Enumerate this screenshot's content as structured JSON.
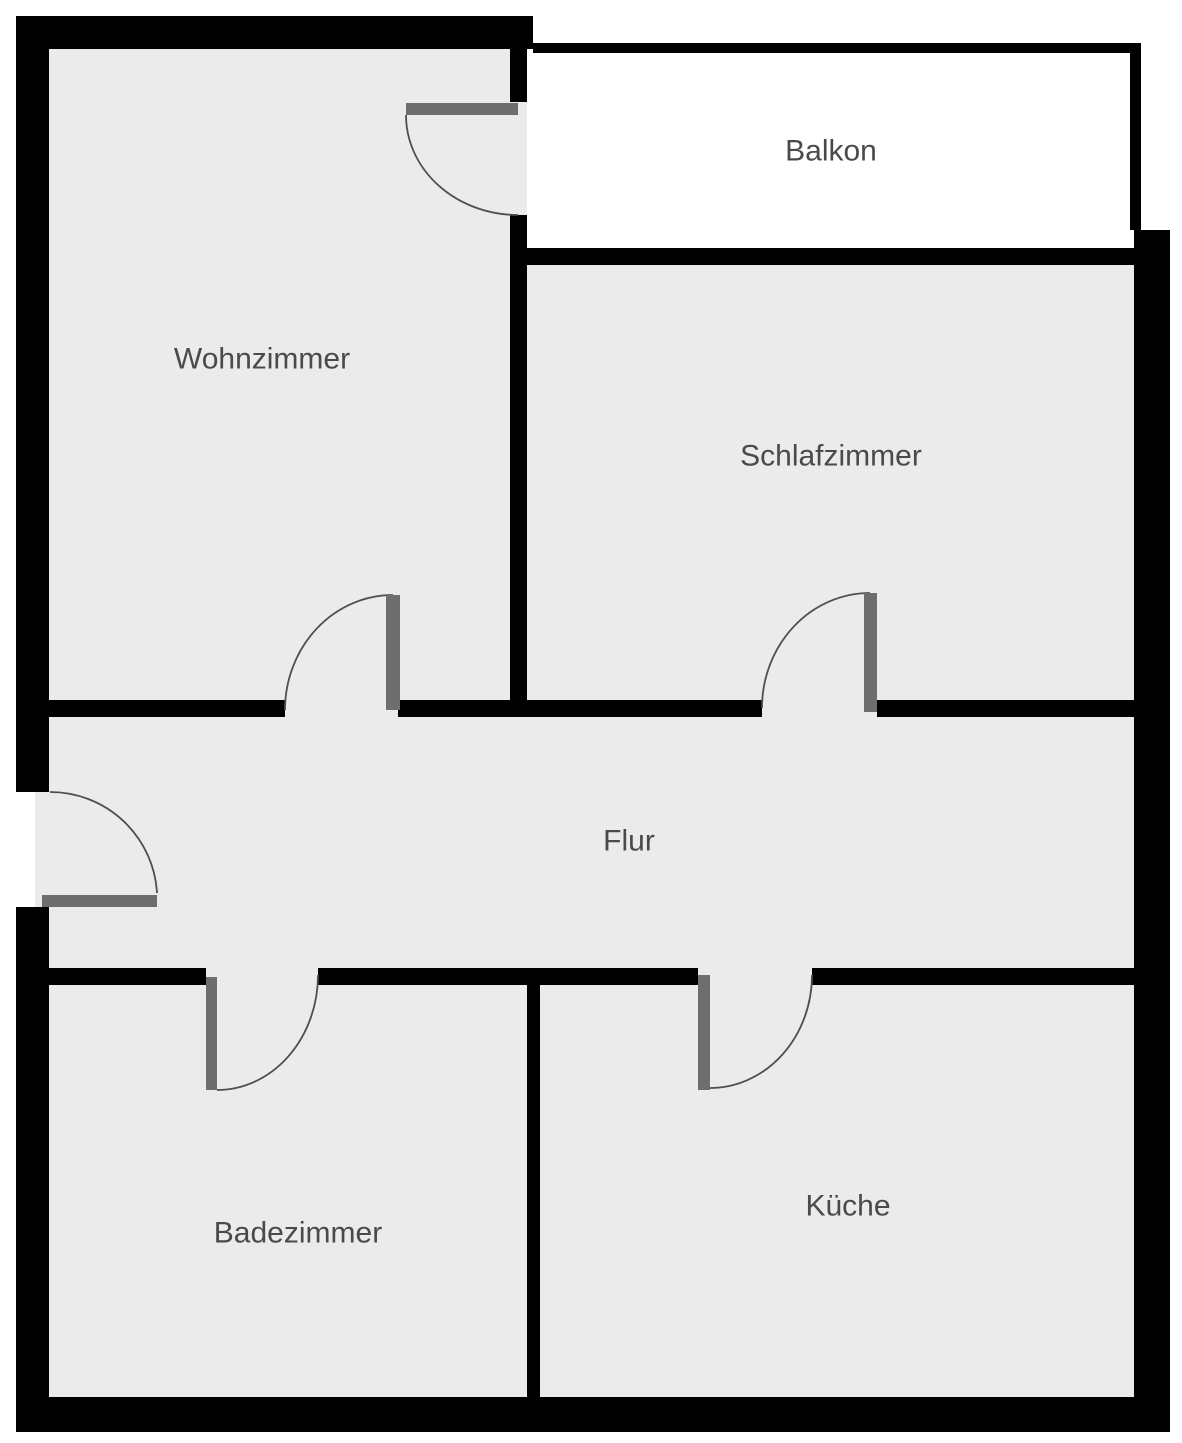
{
  "diagram_type": "apartment-floor-plan",
  "canvas": {
    "width": 1182,
    "height": 1443
  },
  "colors": {
    "background": "#ffffff",
    "wall": "#000000",
    "floor": "#ebebeb",
    "balcony_floor": "#ffffff",
    "door_leaf": "#6e6e6e",
    "door_arc": "#4f4f4f",
    "label_text": "#4a4a4a"
  },
  "label_font_size": 30,
  "rooms": [
    {
      "name": "wohnzimmer",
      "label": "Wohnzimmer",
      "x": 49,
      "y": 49,
      "w": 461,
      "h": 651,
      "fill": "floor",
      "label_x": 262,
      "label_y": 359
    },
    {
      "name": "balkon",
      "label": "Balkon",
      "x": 527,
      "y": 53,
      "w": 603,
      "h": 195,
      "fill": "balcony_floor",
      "label_x": 831,
      "label_y": 151
    },
    {
      "name": "schlafzimmer",
      "label": "Schlafzimmer",
      "x": 527,
      "y": 265,
      "w": 607,
      "h": 435,
      "fill": "floor",
      "label_x": 831,
      "label_y": 456
    },
    {
      "name": "flur",
      "label": "Flur",
      "x": 49,
      "y": 717,
      "w": 1085,
      "h": 251,
      "fill": "floor",
      "label_x": 629,
      "label_y": 841
    },
    {
      "name": "badezimmer",
      "label": "Badezimmer",
      "x": 49,
      "y": 985,
      "w": 478,
      "h": 412,
      "fill": "floor",
      "label_x": 298,
      "label_y": 1233
    },
    {
      "name": "kueche",
      "label": "Küche",
      "x": 540,
      "y": 985,
      "w": 594,
      "h": 412,
      "fill": "floor",
      "label_x": 848,
      "label_y": 1206
    }
  ],
  "door_openings": [
    {
      "name": "opening-balkon-tuer",
      "x": 510,
      "y": 102,
      "w": 17,
      "h": 113,
      "fill": "floor"
    },
    {
      "name": "opening-wohnzimmer-tuer",
      "x": 285,
      "y": 700,
      "w": 113,
      "h": 17,
      "fill": "floor"
    },
    {
      "name": "opening-schlafzimmer-tuer",
      "x": 762,
      "y": 700,
      "w": 115,
      "h": 17,
      "fill": "floor"
    },
    {
      "name": "opening-badezimmer-tuer",
      "x": 206,
      "y": 968,
      "w": 112,
      "h": 17,
      "fill": "floor"
    },
    {
      "name": "opening-kueche-tuer",
      "x": 698,
      "y": 968,
      "w": 114,
      "h": 17,
      "fill": "floor"
    },
    {
      "name": "opening-eingang-schwelle",
      "x": 35,
      "y": 792,
      "w": 14,
      "h": 115,
      "fill": "floor"
    }
  ],
  "walls": [
    {
      "name": "wall-outer-top",
      "x": 16,
      "y": 16,
      "w": 517,
      "h": 33
    },
    {
      "name": "wall-outer-left-upper",
      "x": 16,
      "y": 16,
      "w": 33,
      "h": 776
    },
    {
      "name": "wall-outer-left-lower",
      "x": 16,
      "y": 907,
      "w": 33,
      "h": 525
    },
    {
      "name": "wall-outer-bottom",
      "x": 16,
      "y": 1397,
      "w": 1154,
      "h": 35
    },
    {
      "name": "wall-outer-right",
      "x": 1134,
      "y": 230,
      "w": 36,
      "h": 1202
    },
    {
      "name": "wall-balkon-rail-top",
      "x": 533,
      "y": 43,
      "w": 608,
      "h": 10
    },
    {
      "name": "wall-balkon-rail-right",
      "x": 1130,
      "y": 43,
      "w": 11,
      "h": 187
    },
    {
      "name": "wall-balkon-bottom",
      "x": 510,
      "y": 248,
      "w": 624,
      "h": 17
    },
    {
      "name": "wall-wohnzimmer-ost-oben",
      "x": 510,
      "y": 43,
      "w": 17,
      "h": 59
    },
    {
      "name": "wall-wohnzimmer-ost-unten",
      "x": 510,
      "y": 215,
      "w": 17,
      "h": 502
    },
    {
      "name": "wall-flur-nord-west",
      "x": 49,
      "y": 700,
      "w": 236,
      "h": 17
    },
    {
      "name": "wall-flur-nord-mitte",
      "x": 398,
      "y": 700,
      "w": 364,
      "h": 17
    },
    {
      "name": "wall-flur-nord-ost",
      "x": 877,
      "y": 700,
      "w": 257,
      "h": 17
    },
    {
      "name": "wall-flur-sued-west",
      "x": 49,
      "y": 968,
      "w": 157,
      "h": 17
    },
    {
      "name": "wall-flur-sued-mitte",
      "x": 318,
      "y": 968,
      "w": 380,
      "h": 17
    },
    {
      "name": "wall-flur-sued-ost",
      "x": 812,
      "y": 968,
      "w": 322,
      "h": 17
    },
    {
      "name": "wall-bad-kueche-trenner",
      "x": 527,
      "y": 985,
      "w": 13,
      "h": 412
    }
  ],
  "doors": [
    {
      "name": "balkon-tuer",
      "leaf": {
        "x": 406,
        "y": 103,
        "w": 112,
        "h": 12
      },
      "arc": "M 406 115 A 112 100 0 0 0 518 215"
    },
    {
      "name": "wohnzimmer-tuer",
      "leaf": {
        "x": 386,
        "y": 595,
        "w": 14,
        "h": 115
      },
      "arc": "M 393 595 A 108 115 0 0 0 285 710"
    },
    {
      "name": "schlafzimmer-tuer",
      "leaf": {
        "x": 864,
        "y": 593,
        "w": 13,
        "h": 119
      },
      "arc": "M 870 593 A 108 115 0 0 0 762 708"
    },
    {
      "name": "eingangs-tuer",
      "leaf": {
        "x": 42,
        "y": 895,
        "w": 115,
        "h": 12
      },
      "arc": "M 50 792 A 107 107 0 0 1 157 893"
    },
    {
      "name": "badezimmer-tuer",
      "leaf": {
        "x": 206,
        "y": 977,
        "w": 11,
        "h": 113
      },
      "arc": "M 318 975 A 101 115 0 0 1 217 1090"
    },
    {
      "name": "kueche-tuer",
      "leaf": {
        "x": 698,
        "y": 975,
        "w": 12,
        "h": 115
      },
      "arc": "M 812 975 A 102 113 0 0 1 710 1088"
    }
  ]
}
